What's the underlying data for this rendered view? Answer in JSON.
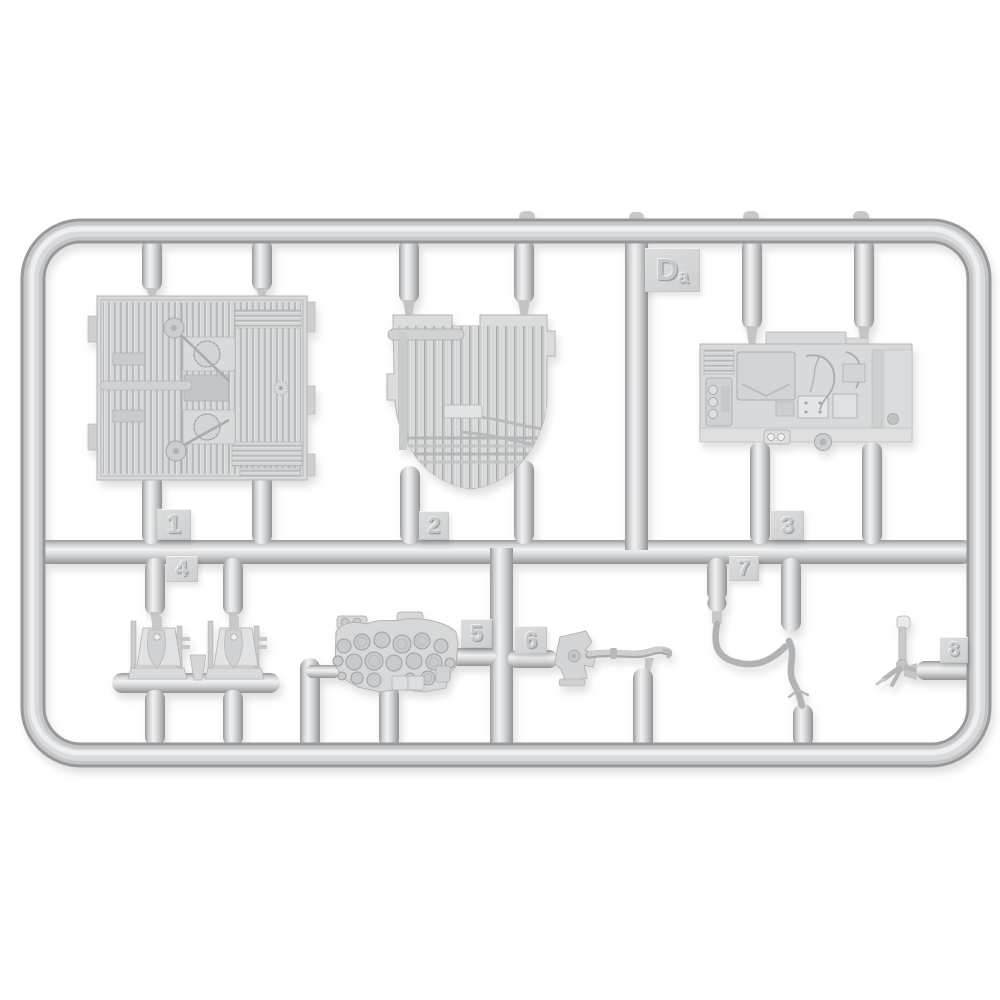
{
  "sprue": {
    "code": {
      "full": "Da",
      "main": "D",
      "sub": "a"
    },
    "part_tabs": [
      {
        "number": "1"
      },
      {
        "number": "2"
      },
      {
        "number": "3"
      },
      {
        "number": "4"
      },
      {
        "number": "5"
      },
      {
        "number": "6"
      },
      {
        "number": "7"
      },
      {
        "number": "8"
      }
    ]
  },
  "colors": {
    "background": "#ffffff",
    "plastic_mid": "#c9cbcd",
    "plastic_light": "#eceeef",
    "plastic_dark": "#96989b",
    "part_fill": "#d7d9da",
    "tab_fill": "#d3d5d7"
  }
}
